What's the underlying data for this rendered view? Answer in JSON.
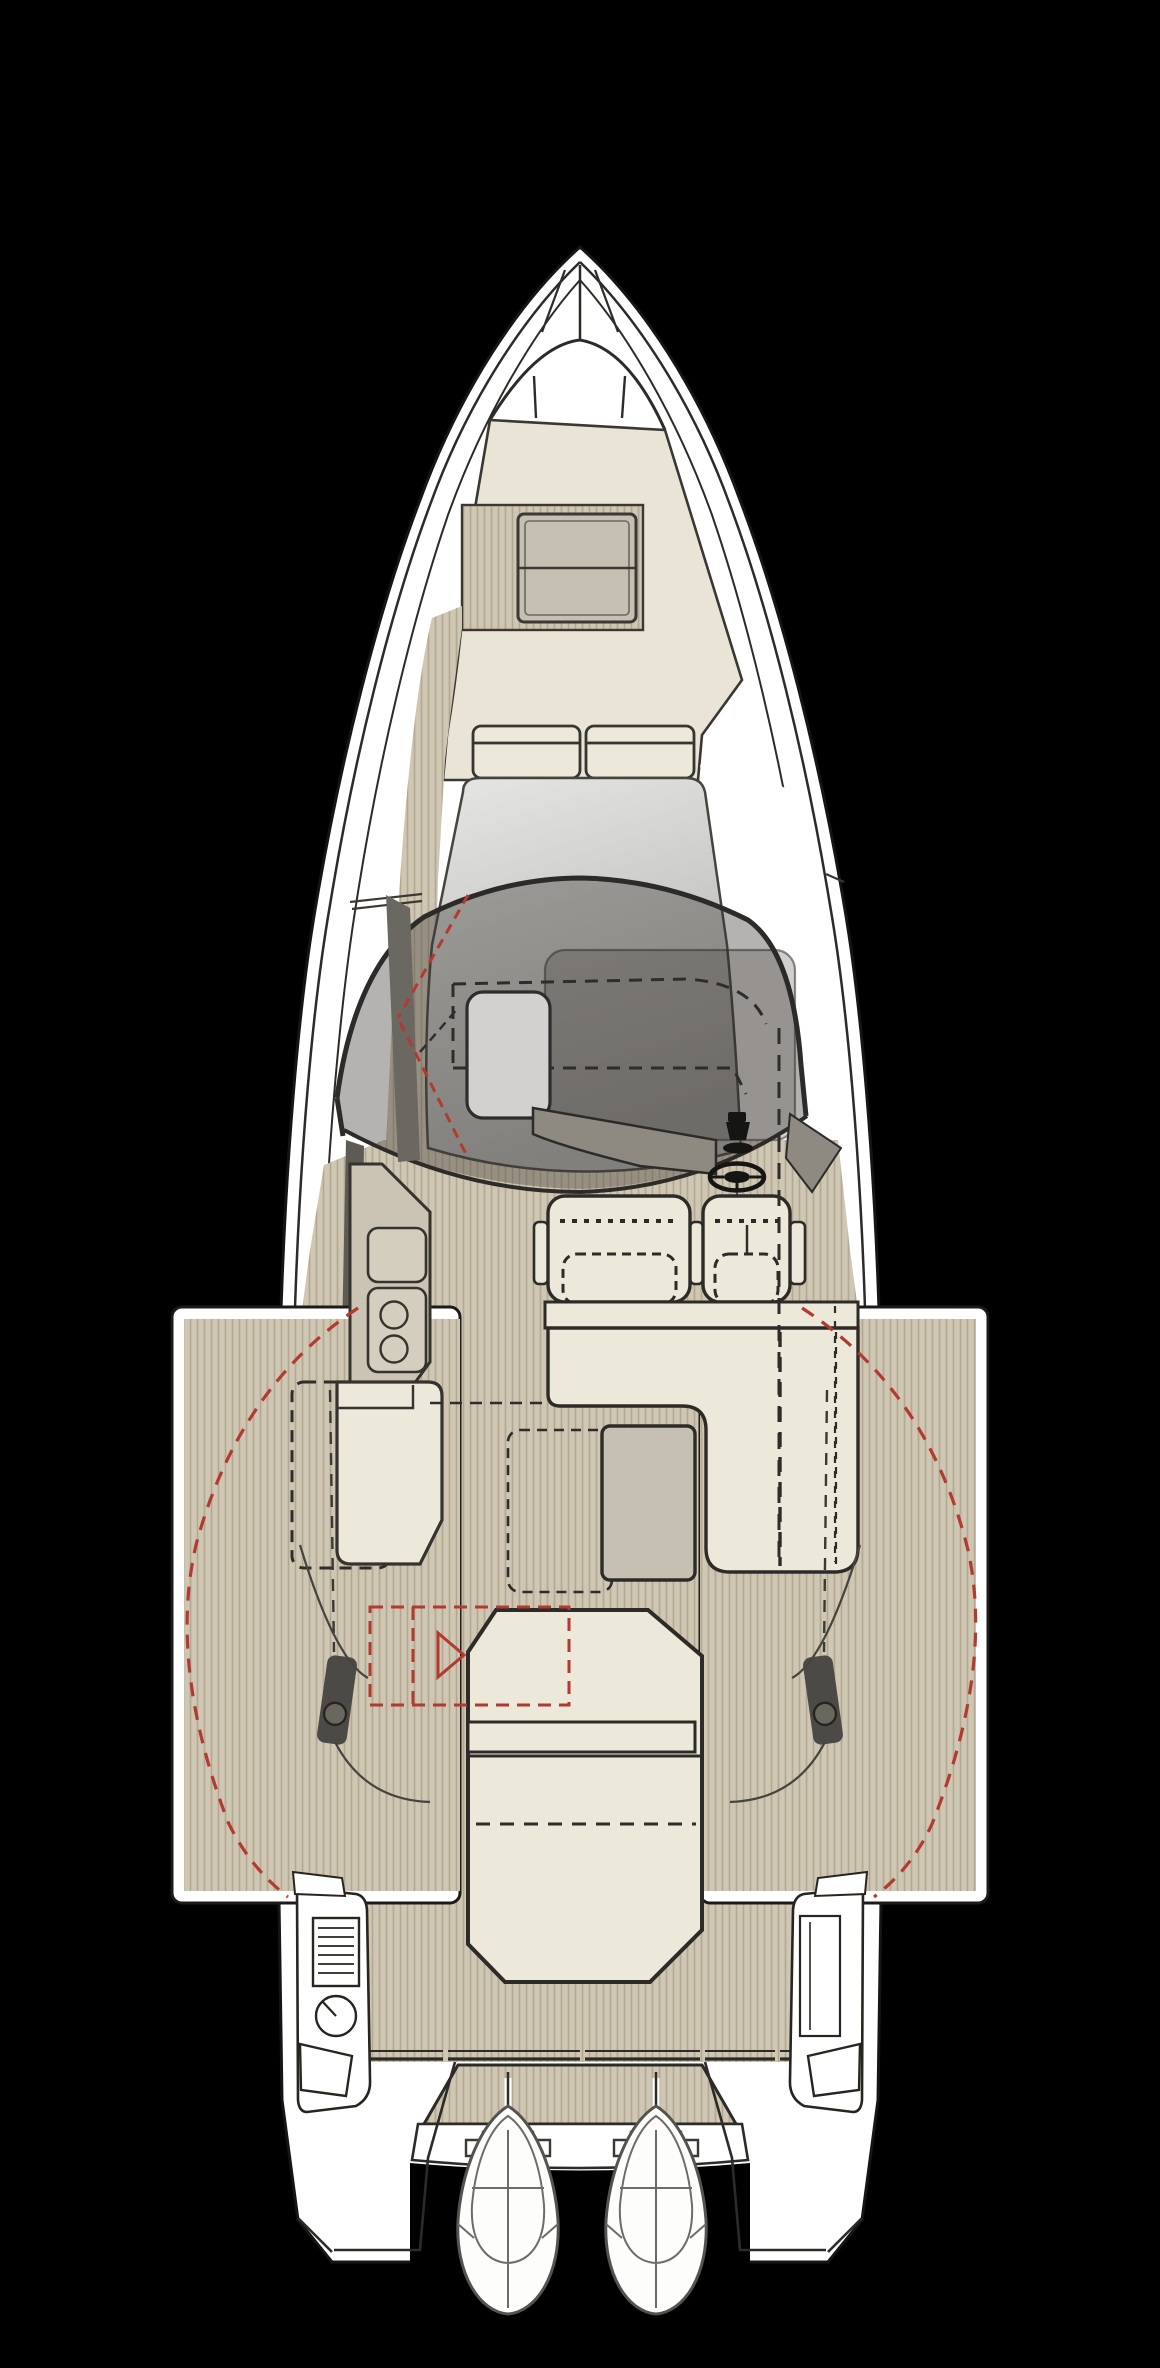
{
  "canvas": {
    "width": 1160,
    "height": 2368
  },
  "diagram": {
    "type": "boat-deck-plan",
    "view": "top-down",
    "visible_text": [],
    "style": "technical floor plan, teak decking shown as vertical striping, optional items in red dashed outline"
  },
  "palette": {
    "background": "#000000",
    "hull_white": "#ffffff",
    "line_dark": "#2c2b28",
    "line_mid": "#55524d",
    "deck_cream": "#e9e4d5",
    "cushion_cream": "#ece8da",
    "teak_base": "#cfc6b3",
    "teak_stripe": "#b3a892",
    "hatch_gray": "#c6c0b2",
    "counter_gray": "#cbc4b4",
    "glass_light": "#e6e6e4",
    "glass_dark": "#adadab",
    "hardtop_tint": "rgba(60,56,49,0.38)",
    "sunroof_tint": "rgba(40,38,34,0.22)",
    "console_gray": "#8f8a81",
    "door_gray": "#6b6761",
    "bulwark_gray": "#5e5a54",
    "accent_red": "#b23a30",
    "cleat_dark": "#4c4a46",
    "engine_white": "#fdfdfc",
    "table_gray": "#c6c0b2"
  },
  "components": [
    "bow-pulpit",
    "anchor-locker-seams",
    "bow-arch",
    "foredeck-sunpad",
    "deck-hatch",
    "bow-backrest-cushions",
    "windshield-glass",
    "windshield-frame-arc",
    "hardtop-overhang",
    "hardtop-sunroof",
    "cabin-hidden-outline-dashes",
    "side-door-panel",
    "door-swing-red-dashes",
    "port-walkway-teak",
    "helm-console",
    "steering-wheel",
    "throttle-lever",
    "helm-bench-seat",
    "helm-single-seat",
    "seat-base",
    "l-shaped-settee",
    "galley-counter",
    "galley-sink",
    "galley-stove-two-burner",
    "port-bench-seat",
    "cockpit-table",
    "table-alt-position-dashes",
    "aft-sunbed",
    "sunbed-backrest-bar",
    "optional-grill-red-outline",
    "optional-marker-triangle",
    "port-fold-down-terrace",
    "starboard-fold-down-terrace",
    "terrace-swing-red-arcs",
    "mooring-cleat-port",
    "mooring-cleat-starboard",
    "transom-rail",
    "stern-console-port",
    "vent-hatch",
    "fuel-gauge-dial",
    "stern-console-starboard",
    "swim-platform",
    "platform-step",
    "outboard-engine-port",
    "outboard-engine-starboard"
  ]
}
